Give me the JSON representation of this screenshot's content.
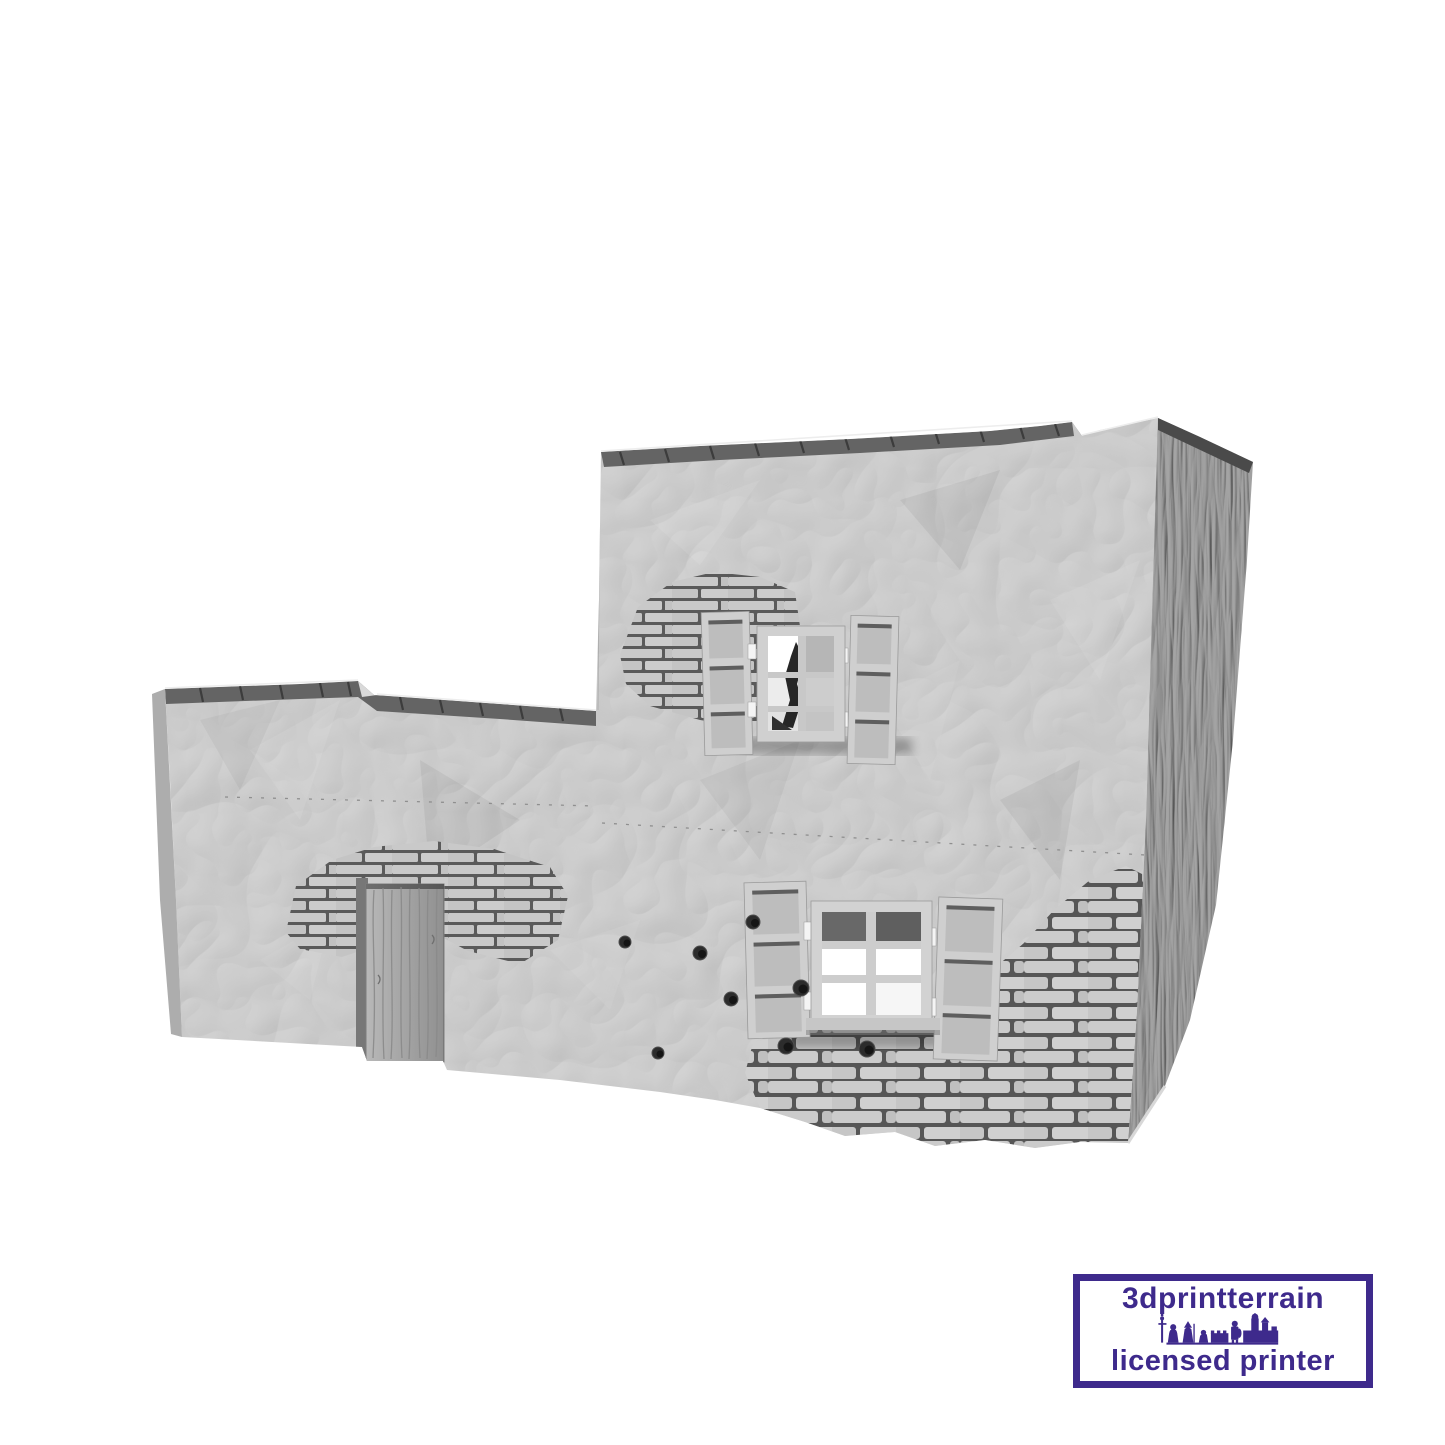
{
  "scene": {
    "background_color": "#ffffff",
    "description": "Grey 3D render of a ruined two-storey stone house (wargaming terrain): broken wall tops, two shuttered windows, a wooden plank door, exposed brickwork and bullet holes"
  },
  "render": {
    "wall_front_color": "#d2d2d2",
    "wall_side_color": "#a6a6a6",
    "wall_top_color": "#646464",
    "wall_edge_highlight": "#ededed",
    "brick_color": "#c9c9c9",
    "mortar_shadow_color": "#5a5a5a",
    "door_color": "#b8b8b8",
    "window_pane_color": "#ffffff",
    "window_recess_color": "#6f6f6f",
    "shutter_color": "#cfcfcf",
    "bullet_hole_color": "#2c2c2c"
  },
  "watermark": {
    "line1": "3dprintterrain",
    "line2": "licensed printer",
    "color": "#3e2a8c",
    "background_color": "#ffffff"
  }
}
